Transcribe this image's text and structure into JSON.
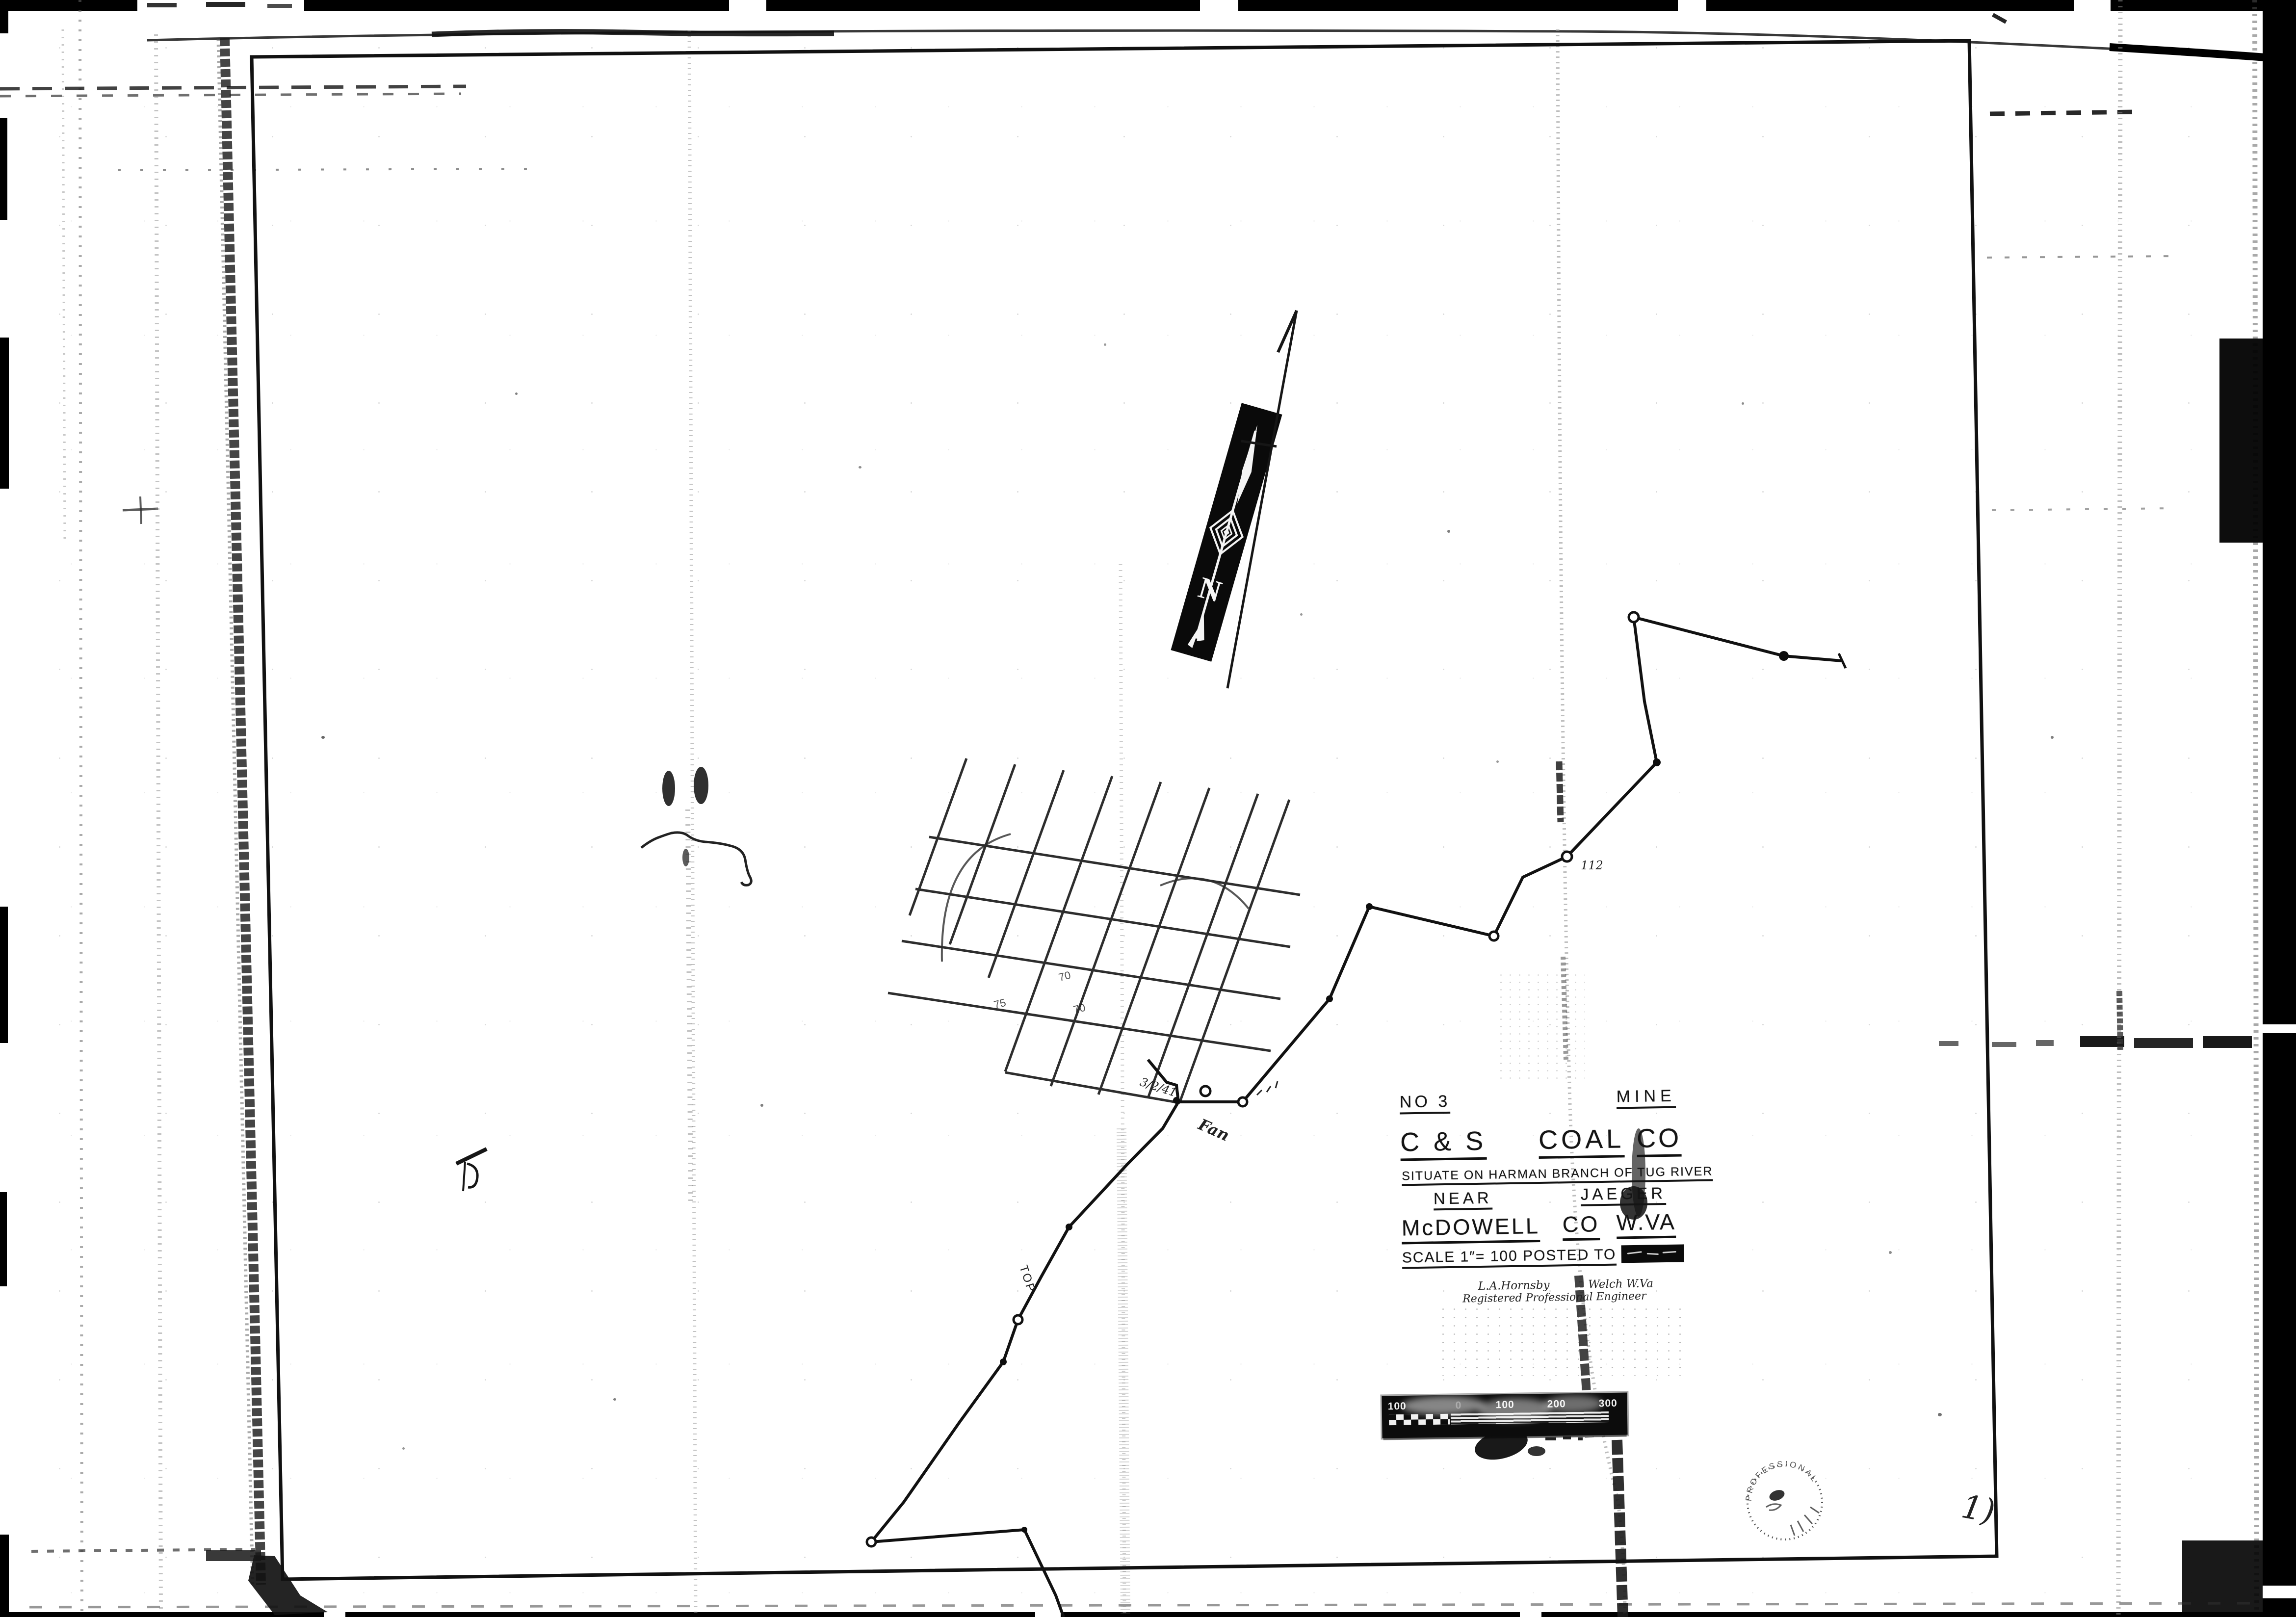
{
  "title_block": {
    "mine_no": "NO 3",
    "mine_word": "MINE",
    "company_part1": "C & S",
    "company_part2": "COAL",
    "company_part3": "CO",
    "situate_line": "SITUATE ON HARMAN BRANCH OF TUG RIVER",
    "near_word": "NEAR",
    "place": "JAEGER",
    "county_name": "McDOWELL",
    "county_word": "CO",
    "state": "W.VA",
    "scale_posted": "SCALE 1″= 100  POSTED TO",
    "signature_name": "L.A.Hornsby",
    "signature_city": "Welch W.Va",
    "signature_title": "Registered Professional Engineer"
  },
  "compass": {
    "north_letter": "N"
  },
  "scale_bar": {
    "labels": [
      "100",
      "0",
      "100",
      "200",
      "300"
    ]
  },
  "annotations": {
    "station_label": "112",
    "fan_label": "Fan",
    "top_label": "TOP",
    "date_note": "3/2/41",
    "grid_number_1": "70",
    "grid_number_2": "70",
    "grid_number_3": "75",
    "corner_mark": "1)",
    "seal_arc_text": "PROFESSIONAL"
  },
  "colors": {
    "ink": "#161616",
    "film_black": "#000000",
    "paper": "#ffffff"
  }
}
